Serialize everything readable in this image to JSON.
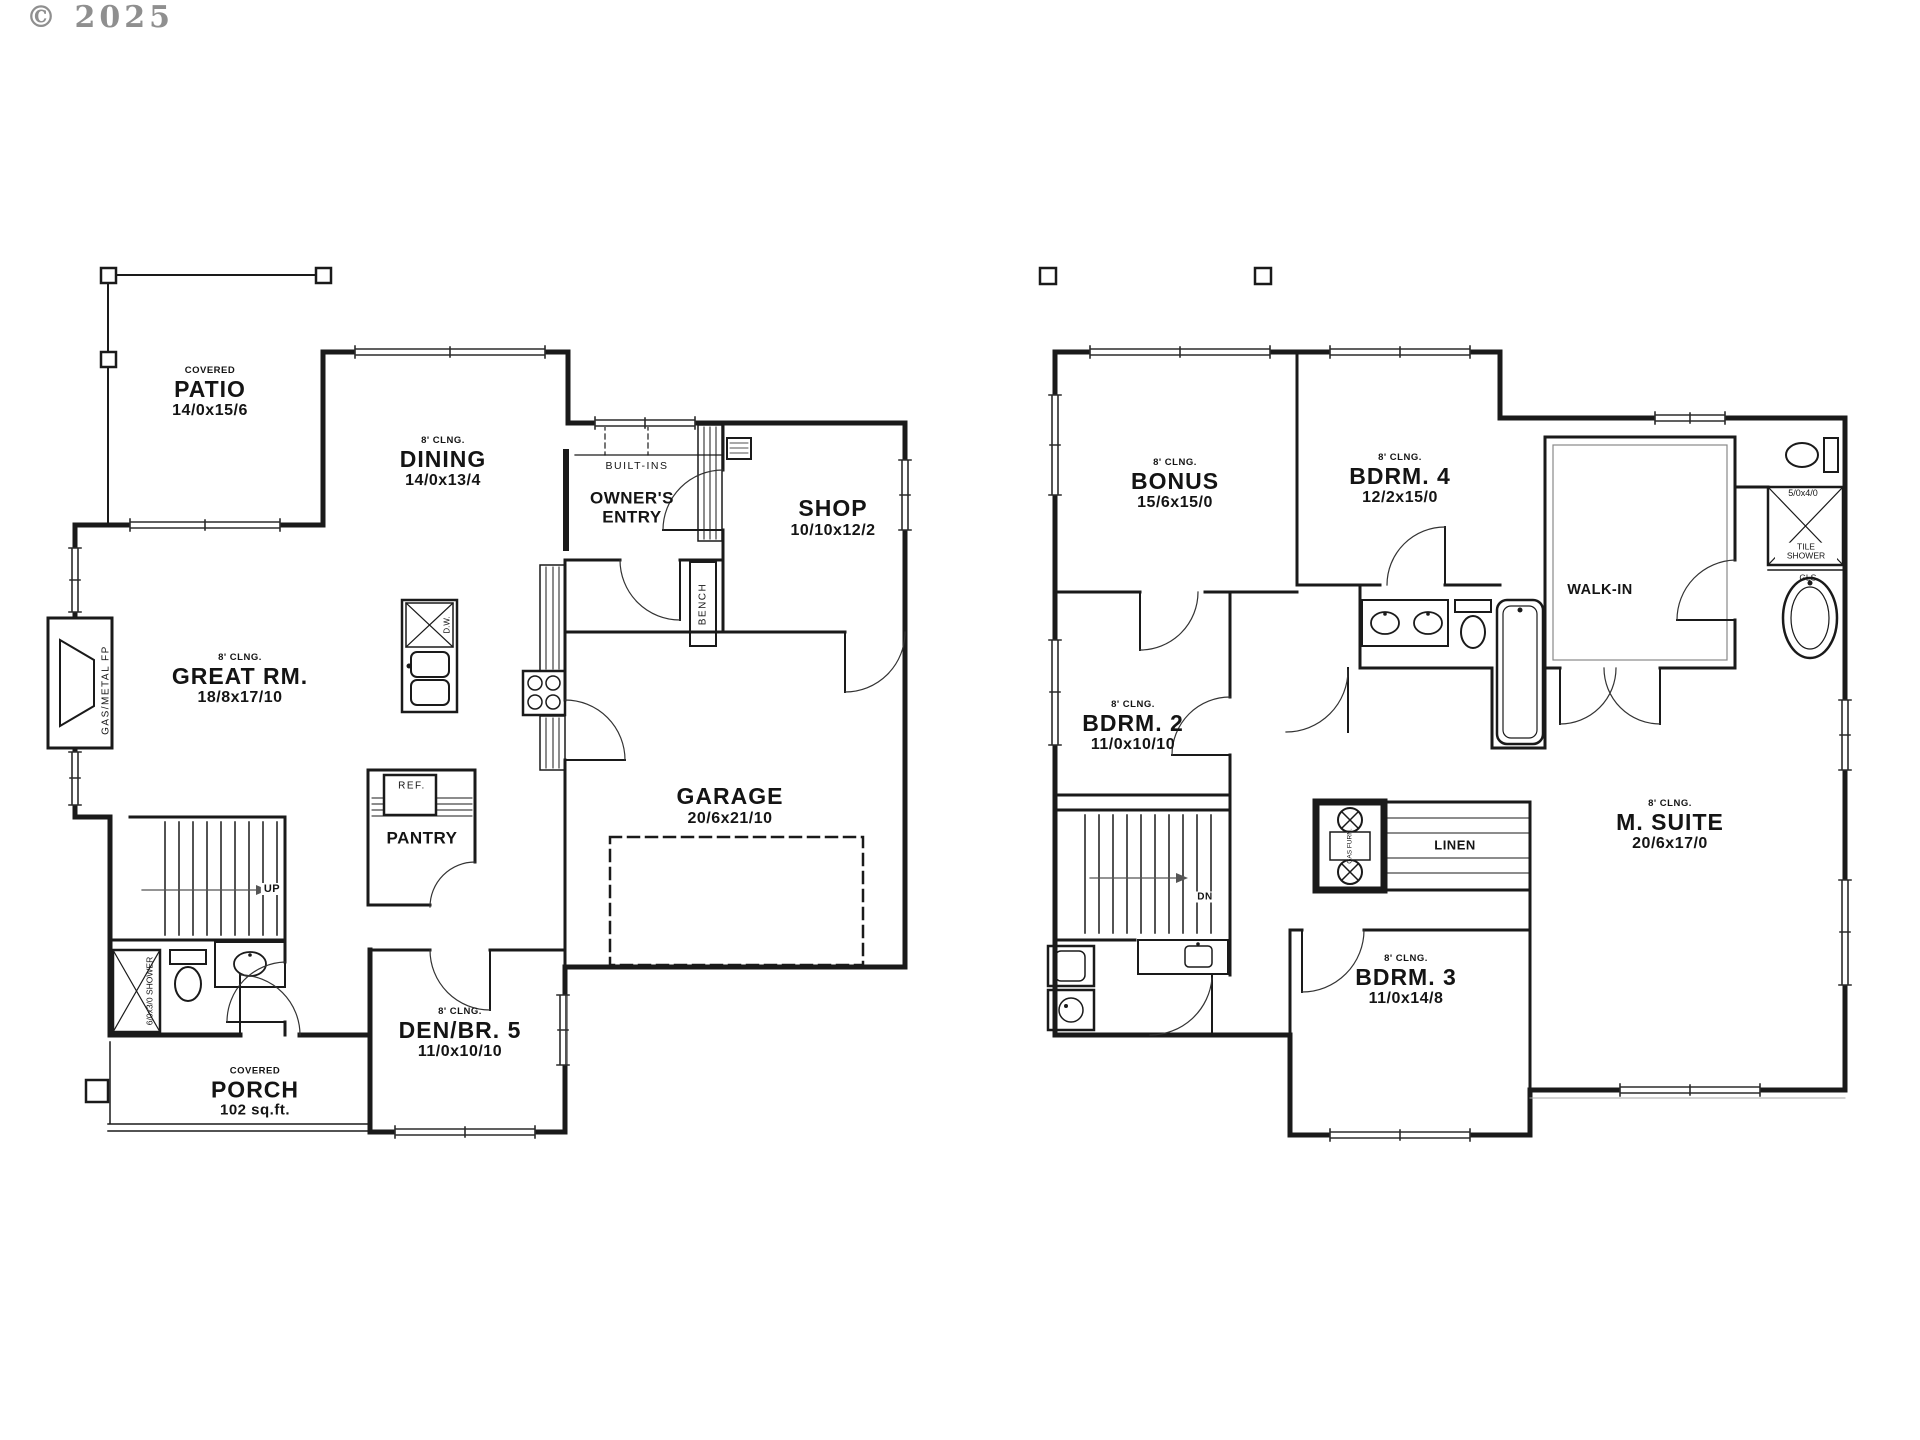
{
  "meta": {
    "watermark": "© 2025",
    "line_color": "#1a1a1a",
    "watermark_color": "#8f8f8f"
  },
  "floor1": {
    "rooms": {
      "patio": {
        "sub": "COVERED",
        "name": "PATIO",
        "dims": "14/0x15/6"
      },
      "dining": {
        "ceiling": "8' CLNG.",
        "name": "DINING",
        "dims": "14/0x13/4"
      },
      "owners_entry": {
        "name": "OWNER'S ENTRY"
      },
      "shop": {
        "name": "SHOP",
        "dims": "10/10x12/2"
      },
      "great_room": {
        "ceiling": "8' CLNG.",
        "name": "GREAT RM.",
        "dims": "18/8x17/10"
      },
      "garage": {
        "name": "GARAGE",
        "dims": "20/6x21/10"
      },
      "pantry": {
        "name": "PANTRY"
      },
      "den": {
        "ceiling": "8' CLNG.",
        "name": "DEN/BR. 5",
        "dims": "11/0x10/10"
      },
      "porch": {
        "sub": "COVERED",
        "name": "PORCH",
        "dims": "102 sq.ft."
      }
    },
    "labels": {
      "built_ins": "BUILT-INS",
      "bench": "BENCH",
      "ref": "REF.",
      "up": "UP",
      "fireplace": "GAS/METAL FP",
      "shower": "6/0x3/0 SHOWER",
      "dw": "D.W."
    }
  },
  "floor2": {
    "rooms": {
      "bonus": {
        "ceiling": "8' CLNG.",
        "name": "BONUS",
        "dims": "15/6x15/0"
      },
      "bdrm4": {
        "ceiling": "8' CLNG.",
        "name": "BDRM. 4",
        "dims": "12/2x15/0"
      },
      "walk_in": {
        "name": "WALK-IN"
      },
      "bdrm2": {
        "ceiling": "8' CLNG.",
        "name": "BDRM. 2",
        "dims": "11/0x10/10"
      },
      "m_suite": {
        "ceiling": "8' CLNG.",
        "name": "M. SUITE",
        "dims": "20/6x17/0"
      },
      "bdrm3": {
        "ceiling": "8' CLNG.",
        "name": "BDRM. 3",
        "dims": "11/0x14/8"
      }
    },
    "labels": {
      "linen": "LINEN",
      "dn": "DN",
      "shower_size": "5/0x4/0",
      "tile_shower": "TILE SHOWER",
      "gls": "GLS.",
      "furnace": "GAS FURN."
    }
  }
}
